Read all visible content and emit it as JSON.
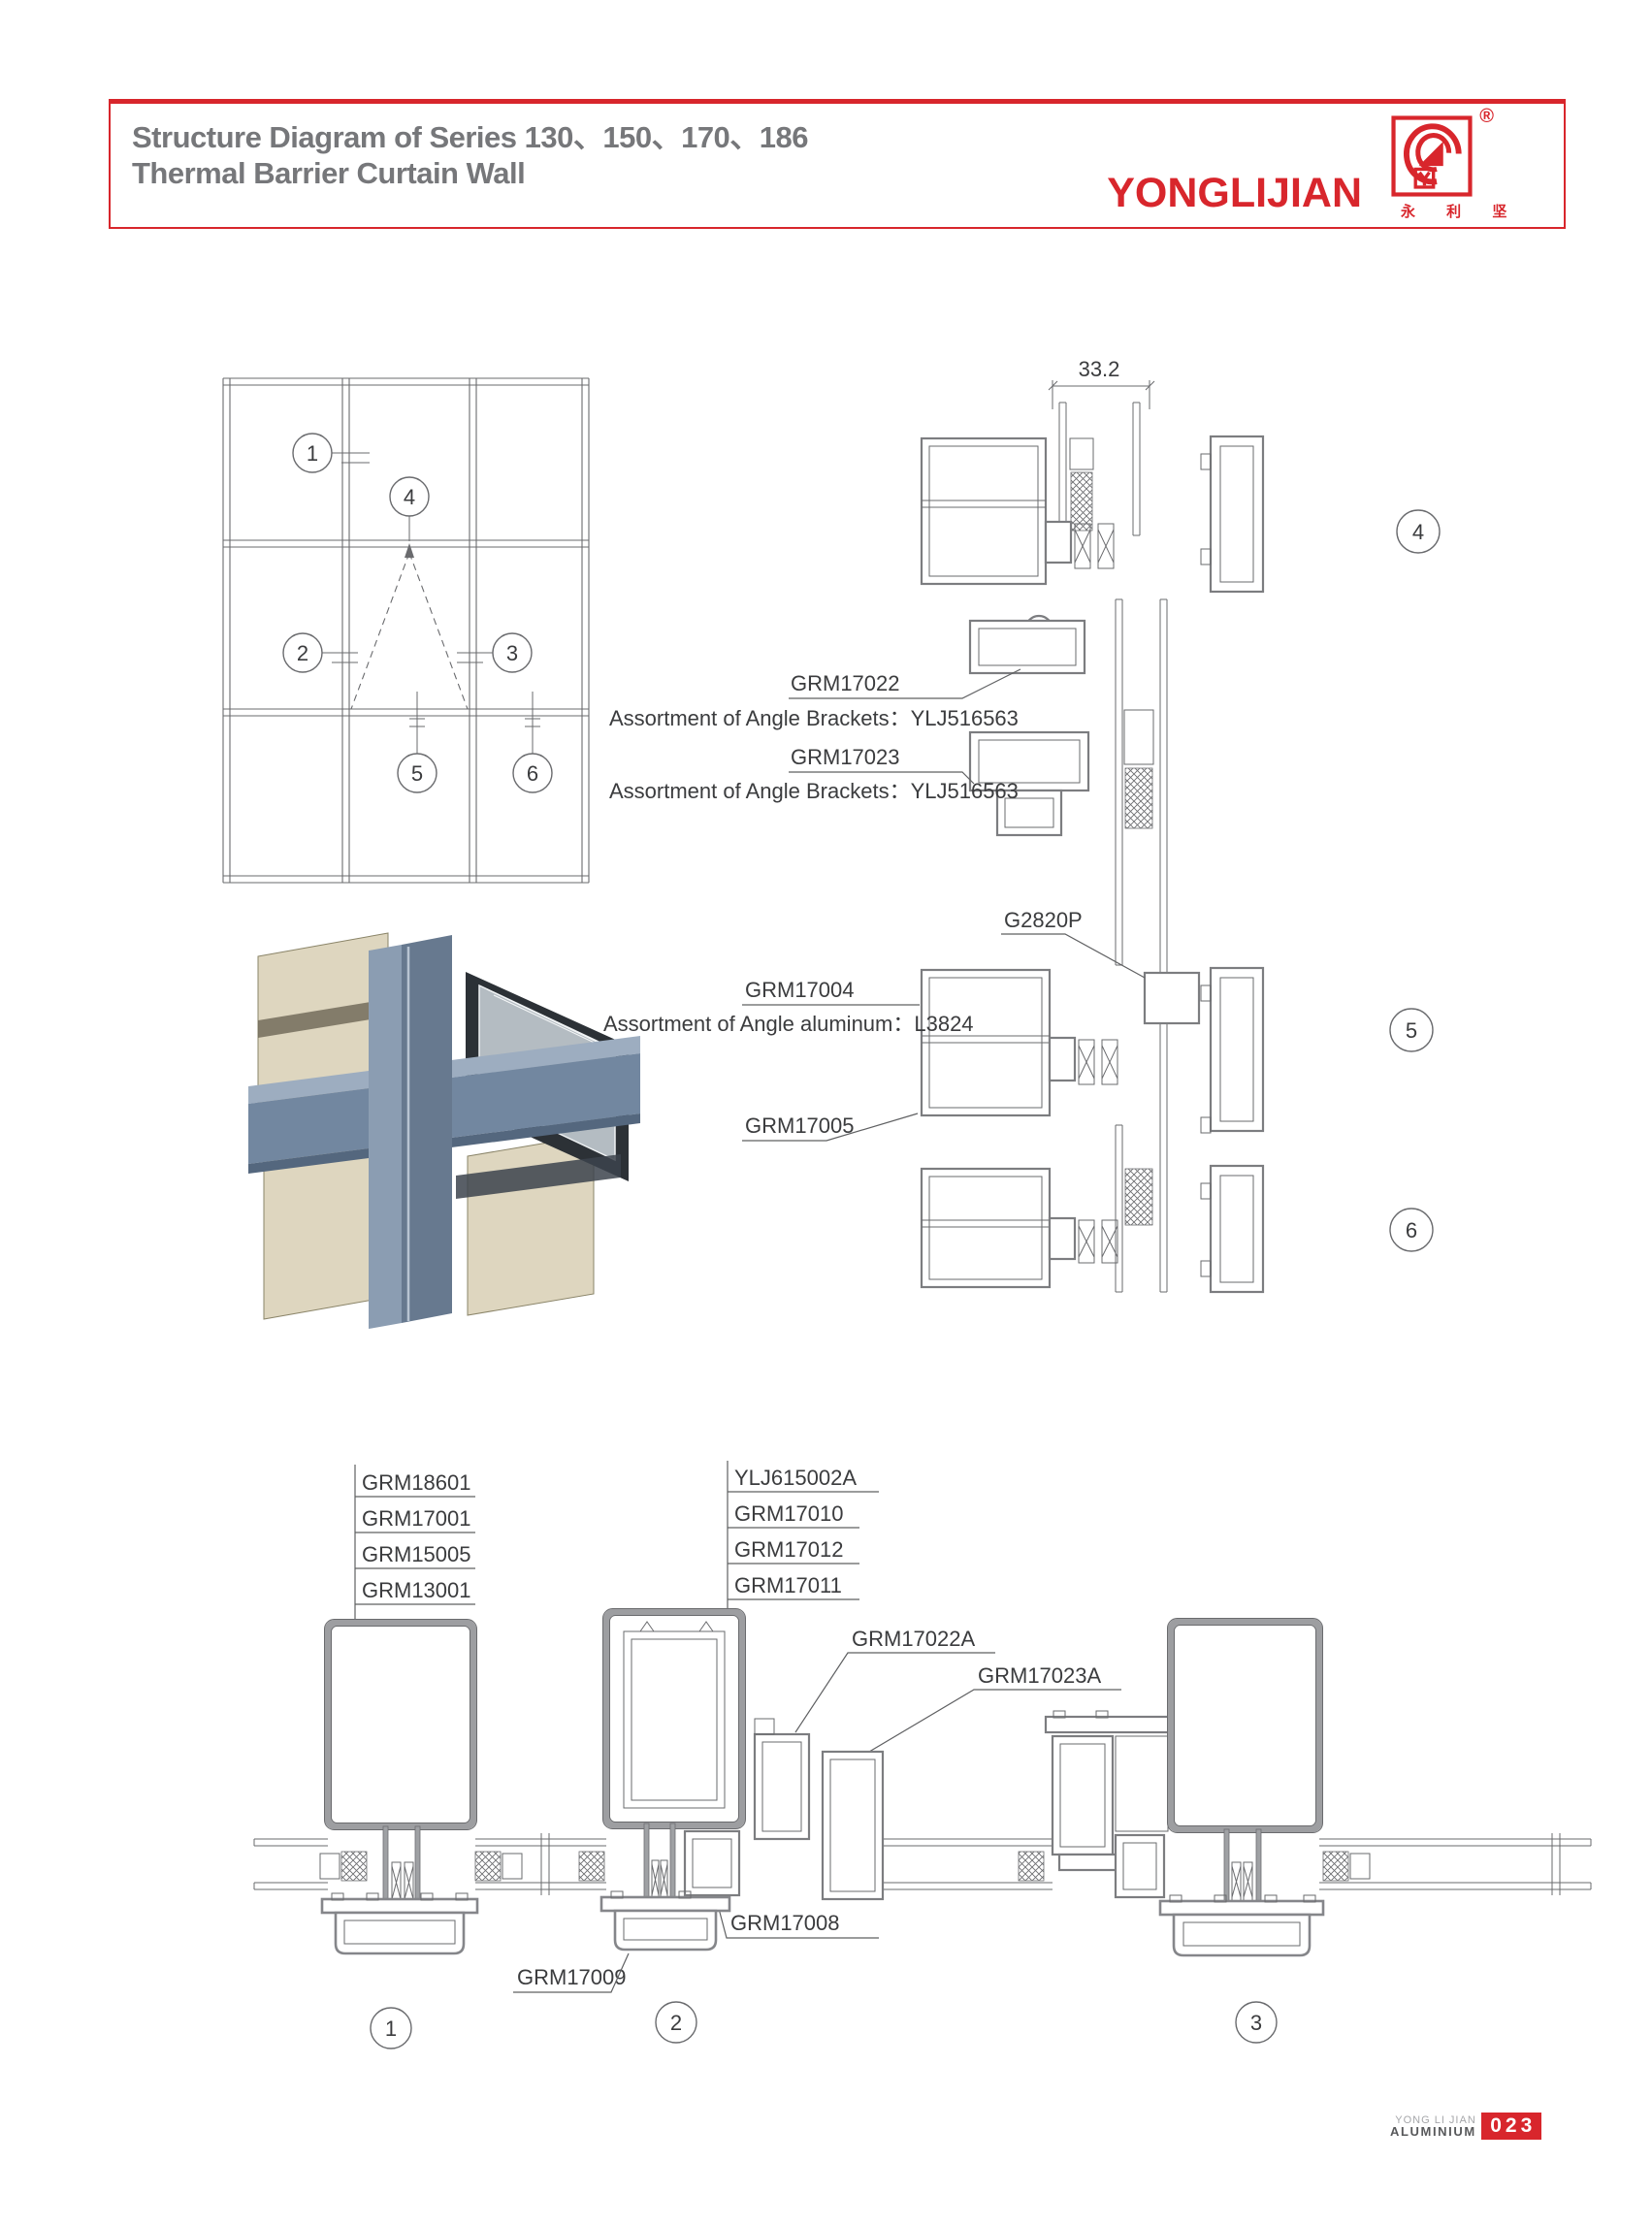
{
  "header": {
    "title_line1": "Structure Diagram of Series 130、150、170、186",
    "title_line2": "Thermal Barrier Curtain Wall",
    "brand": "YONGLIJIAN",
    "brand_cn": "永 利 坚",
    "registered": "®"
  },
  "elevation": {
    "callouts": [
      "1",
      "2",
      "3",
      "4",
      "5",
      "6"
    ]
  },
  "annotations": {
    "dim": "33.2",
    "grm17022": "GRM17022",
    "brackets": "Assortment of Angle Brackets：YLJ516563",
    "grm17023": "GRM17023",
    "g2820p": "G2820P",
    "grm17004": "GRM17004",
    "aluminum": "Assortment of Angle aluminum：L3824",
    "grm17005": "GRM17005",
    "stack_left": [
      "GRM18601",
      "GRM17001",
      "GRM15005",
      "GRM13001"
    ],
    "stack_mid": [
      "YLJ615002A",
      "GRM17010",
      "GRM17012",
      "GRM17011"
    ],
    "grm17022a": "GRM17022A",
    "grm17023a": "GRM17023A",
    "grm17008": "GRM17008",
    "grm17009": "GRM17009"
  },
  "sections": {
    "right_callouts": [
      "4",
      "5",
      "6"
    ],
    "bottom_callouts": [
      "1",
      "2",
      "3"
    ]
  },
  "footer": {
    "company_line1": "YONG LI JIAN",
    "company_line2": "ALUMINIUM",
    "page_number": "023"
  },
  "colors": {
    "accent": "#d8262c",
    "title": "#76777a",
    "line": "#6a6b6e"
  }
}
